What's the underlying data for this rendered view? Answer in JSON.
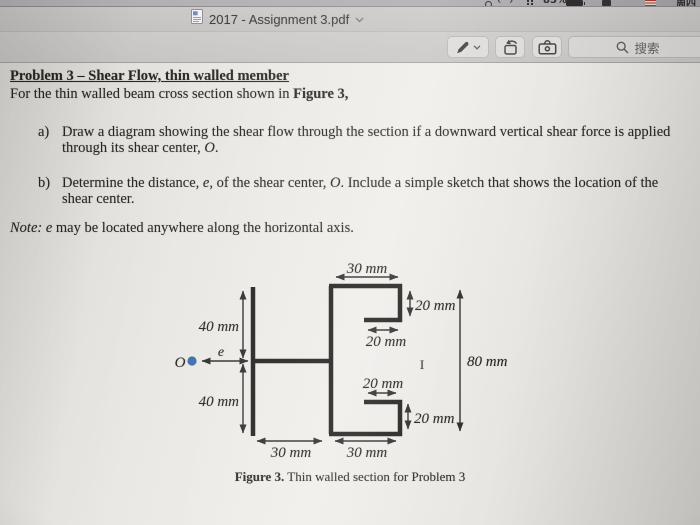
{
  "menu_bar": {
    "prev_glyph": "‹",
    "next_glyph": "›",
    "battery_percent": "85%",
    "weekday": "周四"
  },
  "title_bar": {
    "title": "2017 - Assignment 3.pdf"
  },
  "toolbar": {
    "search_placeholder": "搜索"
  },
  "document": {
    "heading": "Problem 3 – Shear Flow, thin walled member",
    "intro": {
      "pre": "For the thin walled beam cross section shown in ",
      "bold": "Figure 3,"
    },
    "item_a": {
      "marker": "a)",
      "line1": "Draw a diagram showing the shear flow through the section if a downward vertical shear force is applied",
      "line2_pre": "through its shear center, ",
      "line2_var": "O",
      "line2_post": "."
    },
    "item_b": {
      "marker": "b)",
      "line1_pre": "Determine the distance, ",
      "line1_var1": "e",
      "line1_mid": ", of the shear center, ",
      "line1_var2": "O",
      "line1_post": ". Include a simple sketch that shows the location of the",
      "line2": "shear center."
    },
    "note": {
      "italic": "Note: e",
      "rest": " may be located anywhere along the horizontal axis."
    },
    "figure": {
      "dim_top_flange": "30 mm",
      "dim_top_lip": "20 mm",
      "dim_top_return": "20 mm",
      "dim_upper_left": "40 mm",
      "eccentricity_label": "e",
      "shear_center_label": "O",
      "dim_lower_left": "40 mm",
      "dim_total_height": "80 mm",
      "dim_bottom_return": "20 mm",
      "dim_bottom_lip": "20 mm",
      "dim_bottom_left": "30 mm",
      "dim_bottom_right": "30 mm",
      "cursor_mark": "I",
      "caption_bold": "Figure 3.",
      "caption_rest": " Thin walled section for Problem 3"
    }
  },
  "colors": {
    "shear_center_dot": "#3a6ca8",
    "section_line": "#1f1d1b",
    "toolbar_bg": "#cbc9c7"
  },
  "icons": {
    "title_file": "pdf-document",
    "title_chevron": "chevron-down",
    "markup": "marker-pen",
    "rotate": "rotate-left",
    "toolbox": "markup-toolbox",
    "search": "magnifier"
  }
}
